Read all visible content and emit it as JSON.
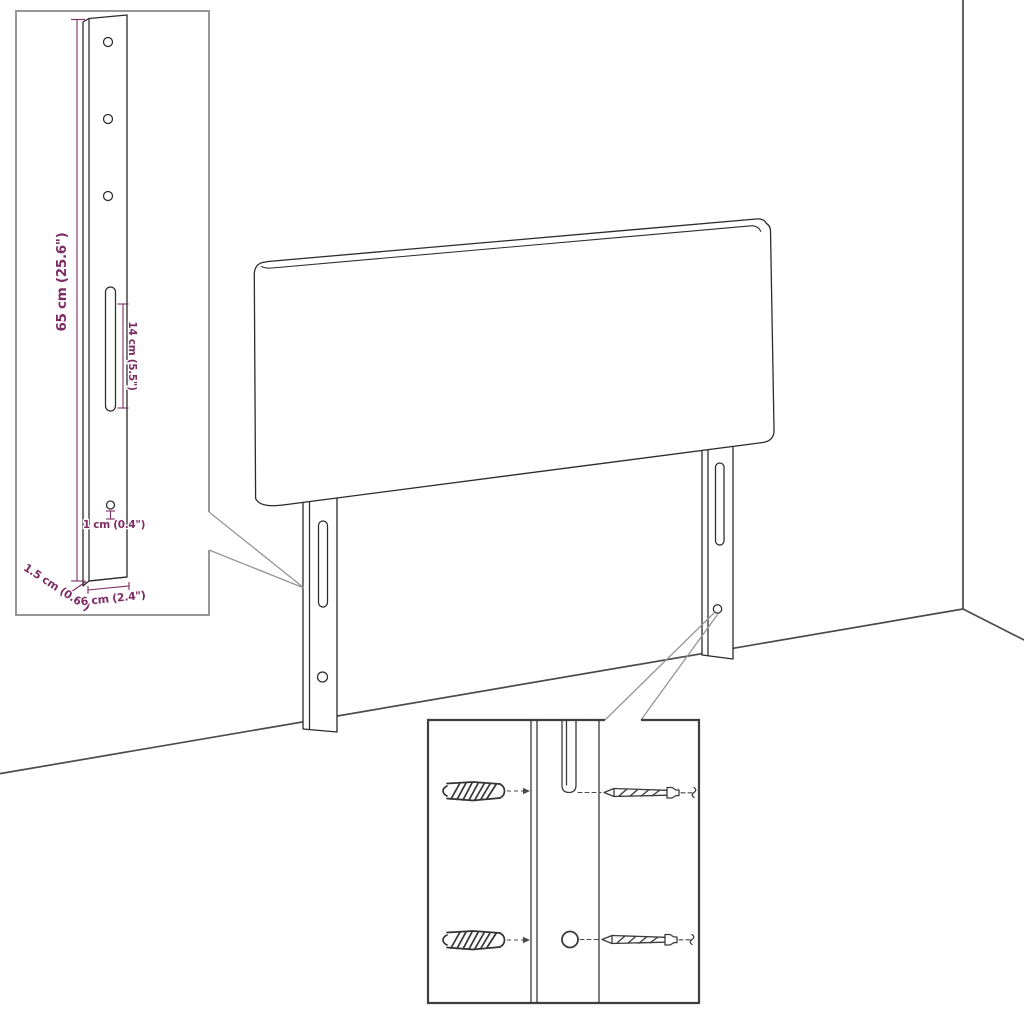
{
  "diagram": {
    "subject": "headboard-wall-mount-assembly-diagram",
    "labels": {
      "leg_height": "65 cm (25.6\")",
      "slot_length": "14 cm (5.5\")",
      "hole_diameter": "1 cm (0.4\")",
      "leg_thickness": "1.5 cm (0.6\")",
      "leg_width": "6 cm (2.4\")"
    },
    "colors": {
      "dimension_text": "#7d2d64",
      "outline": "#2b2b2b",
      "callout_line": "#969696",
      "room_line": "#4b4b4b",
      "leg_detail_inset_border": "#979797",
      "hardware_inset_border": "#3f3f3f",
      "background": "#ffffff"
    }
  }
}
